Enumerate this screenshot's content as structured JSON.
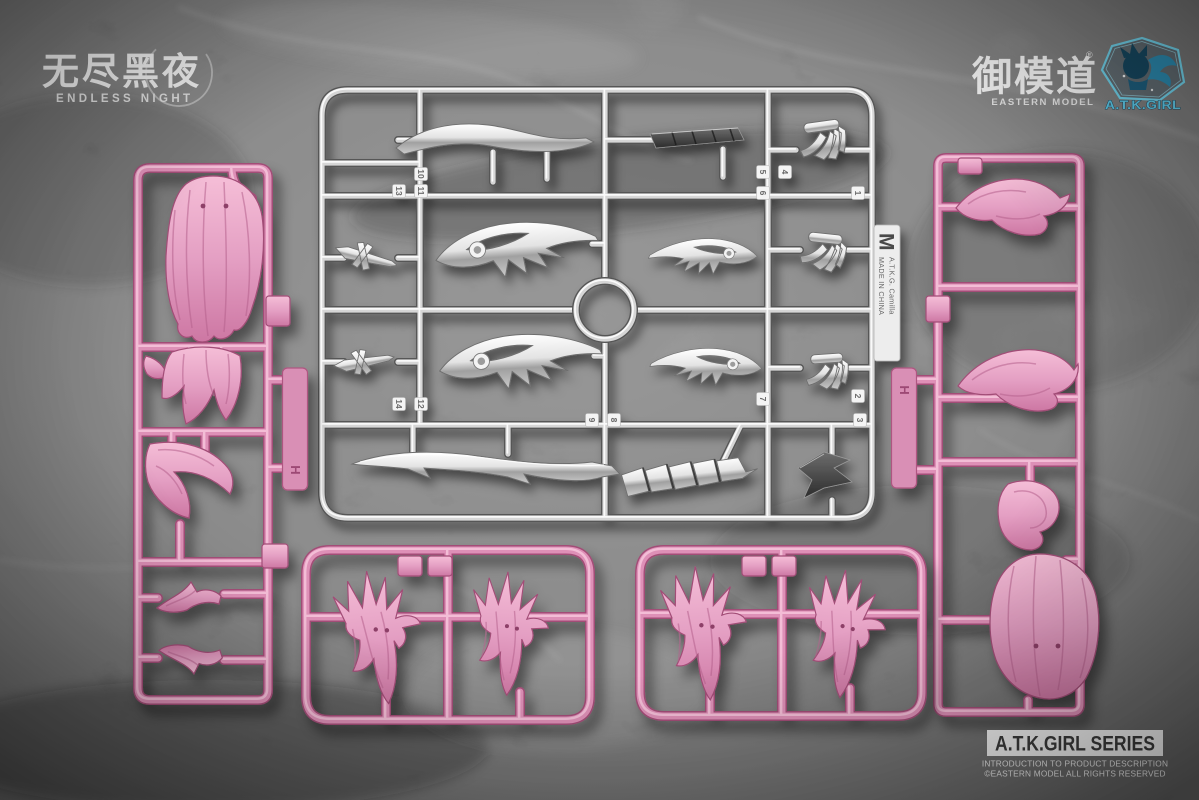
{
  "branding": {
    "logo_cjk": "无尽黑夜",
    "logo_en": "ENDLESS NIGHT",
    "maker_cjk": "御模道",
    "maker_reg": "®",
    "maker_en": "EASTERN MODEL",
    "girl_logo": "A.T.K.GIRL"
  },
  "footer": {
    "series_title": "A.T.K.GIRL SERIES",
    "line1": "INTRODUCTION TO PRODUCT DESCRIPTION",
    "line2": "©EASTERN MODEL ALL RIGHTS RESERVED"
  },
  "metal_sprue": {
    "runner_letter": "M",
    "label_product": "A.T.K.G. Camilla",
    "label_origin": "MADE IN CHINA",
    "part_tags": [
      "10",
      "13",
      "11",
      "5",
      "4",
      "6",
      "1",
      "14",
      "12",
      "7",
      "2",
      "3",
      "9",
      "8"
    ]
  },
  "pink_sprue_left": {
    "runner_letter": "H"
  },
  "pink_sprue_right": {
    "runner_letter": "H"
  },
  "colors": {
    "marble_base": "#7f7f7f",
    "pink": "#de90b7",
    "pink_dark": "#a24d77",
    "pink_light": "#f7c6dc",
    "chrome_light": "#ececec",
    "chrome_dark": "#565656",
    "badge_cyan": "#5ec8e6",
    "badge_teal_dark": "#16475f"
  }
}
